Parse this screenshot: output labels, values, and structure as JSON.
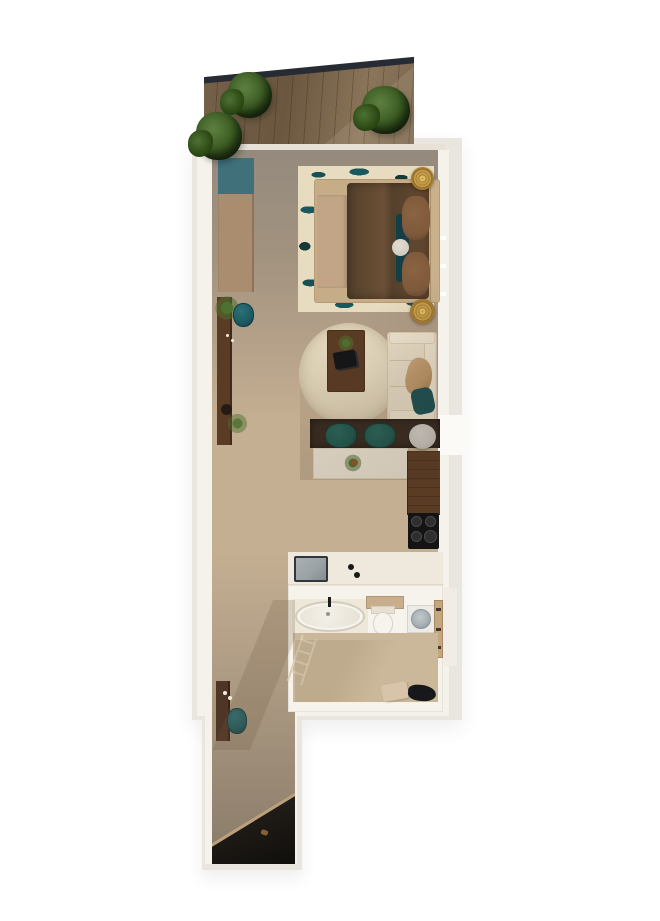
{
  "scene": {
    "name": "apartment-floor-plan-top-view",
    "orientation": "vertical",
    "visible_text": ""
  },
  "rooms": {
    "balcony": {
      "label": "Balcony"
    },
    "bedroom": {
      "label": "Bedroom"
    },
    "living": {
      "label": "Living area"
    },
    "dining": {
      "label": "Dining nook"
    },
    "kitchen": {
      "label": "Kitchen"
    },
    "bathroom": {
      "label": "Bathroom"
    },
    "hallway": {
      "label": "Hallway"
    },
    "entry": {
      "label": "Entry"
    }
  },
  "furniture": {
    "deck": "Wood deck",
    "railing": "Glass railing",
    "plant": "Potted plant",
    "wardrobe": "Wardrobe",
    "bed_rug": "Patterned area rug",
    "bed": "Double bed",
    "bed_runner": "Bed runner",
    "duvet": "Brown duvet",
    "pillow": "Pillow",
    "teal_cushion": "Teal cushion",
    "round_cushion": "Round cushion",
    "headboard": "Headboard",
    "nightstand": "Round nightstand",
    "console": "Console shelf",
    "stool": "Teal stool",
    "bowl": "Decor bowl",
    "round_rug": "Round rug",
    "coffee_table": "Coffee table",
    "books": "Stacked books",
    "sofa": "Sofa",
    "throw": "Throw blanket",
    "sofa_pillow": "Sofa pillow",
    "dining_counter": "Dining counter",
    "dining_chair": "Dining chair",
    "side_table": "Round side table",
    "island": "Kitchen island",
    "cabinet": "Tall cabinet",
    "cooktop": "Induction cooktop",
    "burner": "Burner",
    "sink": "Kitchen sink",
    "faucet": "Faucet",
    "bathtub": "Bathtub",
    "shelf": "Bathroom shelf",
    "toilet": "Toilet",
    "washer": "Washing machine",
    "door": "Bathroom door",
    "ladder": "Towel ladder",
    "mat": "Bath mat",
    "laundry": "Laundry pile",
    "entry_door": "Entry door shadow",
    "threshold": "Threshold"
  },
  "palette": {
    "exterior_wall": "#e9e5df",
    "interior_wall": "#f5f2ec",
    "wall_top": "#e7e1d8",
    "deck_wood": "#75614a",
    "deck_wood_light": "#8a755a",
    "railing": "#272b33",
    "plant_green": "#37571f",
    "floor_grey": "#948a7d",
    "floor_tan": "#c4af92",
    "floor_dark": "#897a69",
    "rug_cream": "#e8dcc0",
    "teal": "#1d5b61",
    "teal_dark": "#143f46",
    "duvet": "#5e452e",
    "pillow_brown": "#7d583a",
    "bed_frame": "#c7ac88",
    "gold": "#c59c48",
    "wood_dark": "#5a3b24",
    "counter_dark": "#36291f",
    "sofa_cream": "#e9dec8",
    "island_cream": "#f0e8d8",
    "cooktop": "#141414",
    "sink_grey": "#9aa1a5",
    "fixture_white": "#f6f4ee",
    "washer_drum": "#aab1b6",
    "throw_tan": "#bd9769",
    "grey_table": "#c9c6c0",
    "entry_dark": "#1b1814"
  }
}
